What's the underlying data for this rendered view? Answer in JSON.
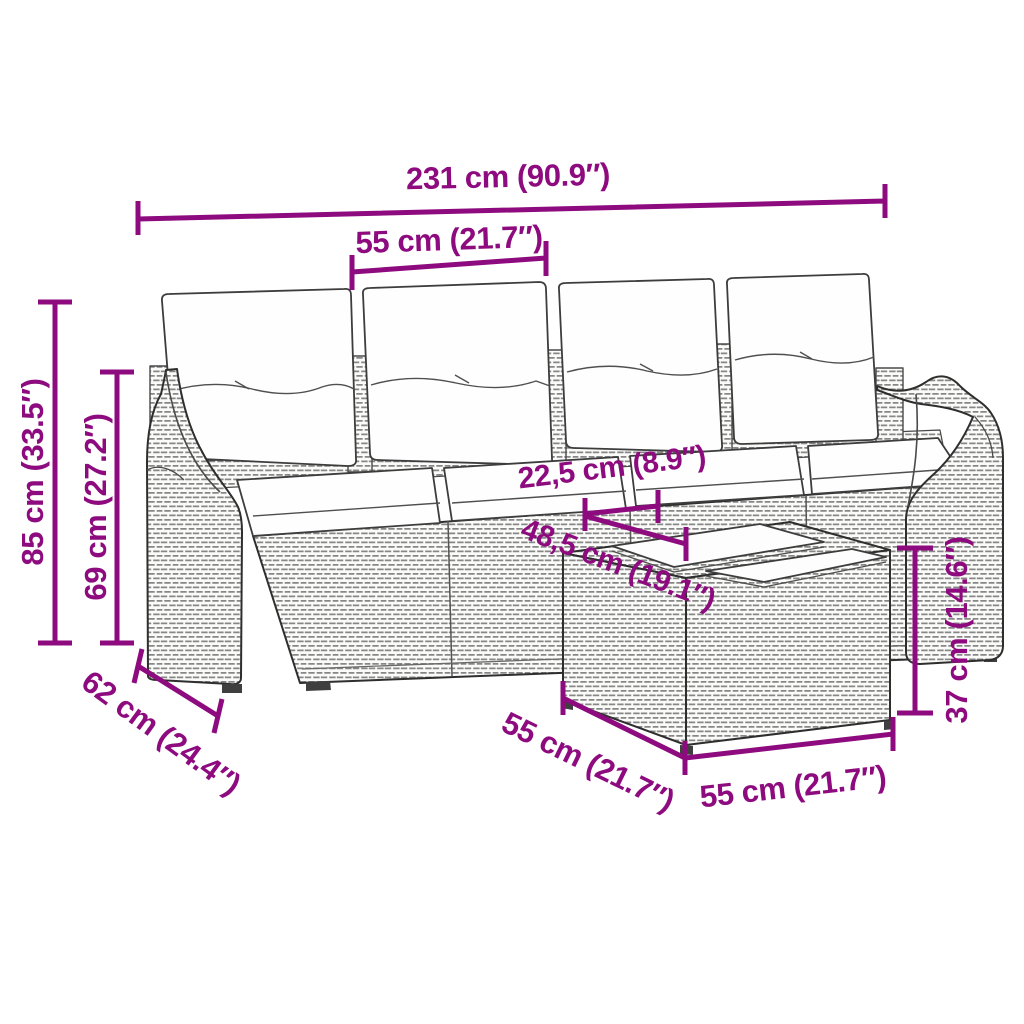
{
  "diagram": {
    "product": "Poly rattan garden lounge set line drawing: 4-seat sofa with back and seat cushions plus rattan ottoman table with two tray tops",
    "background_color": "#ffffff",
    "dimension_color": "#8D0B7E",
    "outline_color": "#2e2e2e",
    "dimensions": [
      {
        "id": "overall-width",
        "label": "231 cm (90.9″)"
      },
      {
        "id": "module-width",
        "label": "55 cm (21.7″)"
      },
      {
        "id": "overall-height",
        "label": "85 cm (33.5″)"
      },
      {
        "id": "back-height",
        "label": "69 cm (27.2″)"
      },
      {
        "id": "sofa-to-table-gap",
        "label": "22,5 cm (8.9″)"
      },
      {
        "id": "table-top-diagonal",
        "label": "48,5 cm (19.1″)"
      },
      {
        "id": "seat-depth",
        "label": "62 cm (24.4″)"
      },
      {
        "id": "table-side-depth",
        "label": "55 cm (21.7″)"
      },
      {
        "id": "table-front-width",
        "label": "55 cm (21.7″)"
      },
      {
        "id": "table-height",
        "label": "37 cm (14.6″)"
      }
    ]
  }
}
